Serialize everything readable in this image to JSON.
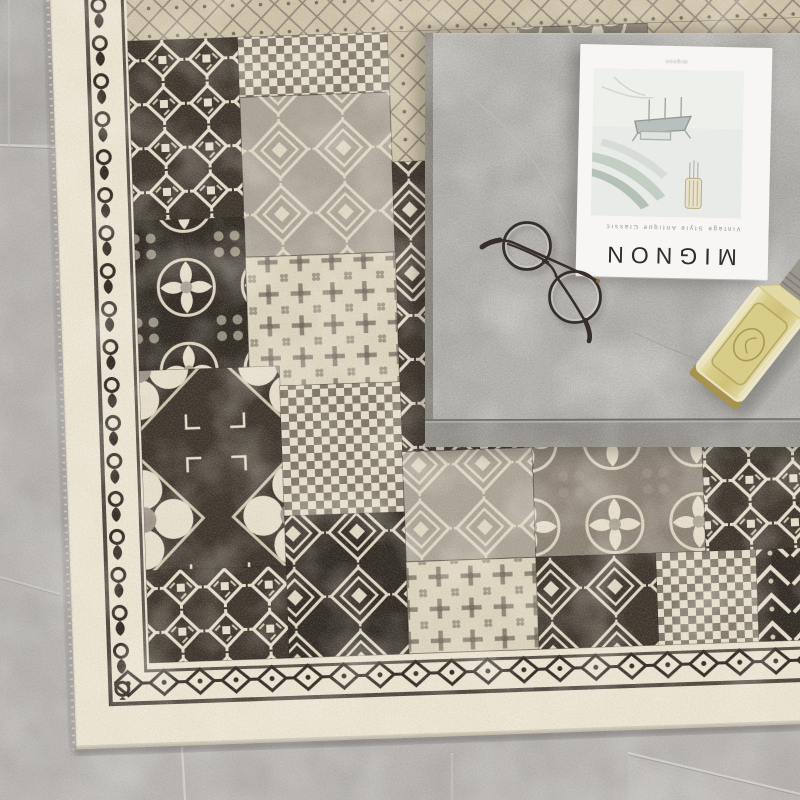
{
  "scene": {
    "floor": {
      "base": "#b8b5b2",
      "grout_light": "#d6d4d0",
      "grout_dark": "#94918c",
      "grout_lines": [
        {
          "x1": 0,
          "y1": 145,
          "x2": 58,
          "y2": 147,
          "strength": 0.8
        },
        {
          "x1": 9,
          "y1": 0,
          "x2": 9,
          "y2": 144,
          "strength": 0.35
        },
        {
          "x1": 0,
          "y1": 577,
          "x2": 60,
          "y2": 594,
          "strength": 0.5
        },
        {
          "x1": 182,
          "y1": 747,
          "x2": 185,
          "y2": 800,
          "strength": 0.9
        },
        {
          "x1": 452,
          "y1": 753,
          "x2": 452,
          "y2": 800,
          "strength": 0.45
        },
        {
          "x1": 628,
          "y1": 753,
          "x2": 800,
          "y2": 794,
          "strength": 0.8
        }
      ]
    },
    "table": {
      "material": "concrete",
      "surface": "#b4b2af",
      "bottom_edge": "#928f8a",
      "left_edge": "#86837d"
    },
    "rug": {
      "style": "vintage-patchwork",
      "selvage": "#ece5d2",
      "field": "#8a8173",
      "dark": "#3a332a",
      "darker": "#2e2821",
      "cream": "#e7dfcc",
      "gray": "#aaa396",
      "tan": "#cfc3a8",
      "borders": {
        "left": "vine-scroll",
        "bottom": "zigzag-diamond",
        "top": "diamond-lattice"
      },
      "patches": [
        {
          "x": 76,
          "y": 46,
          "w": 110,
          "h": 180,
          "base": "#3a332a",
          "pat": "p-hooks"
        },
        {
          "x": 186,
          "y": 46,
          "w": 150,
          "h": 60,
          "base": "#6b6254",
          "pat": "p-checker"
        },
        {
          "x": 336,
          "y": 46,
          "w": 130,
          "h": 130,
          "base": "#cfc3a8",
          "pat": "p-lattice"
        },
        {
          "x": 466,
          "y": 46,
          "w": 130,
          "h": 120,
          "base": "#8a8173",
          "pat": "p-floral"
        },
        {
          "x": 596,
          "y": 46,
          "w": 188,
          "h": 140,
          "base": "#cfc3a8",
          "pat": "p-lattice"
        },
        {
          "x": 186,
          "y": 106,
          "w": 150,
          "h": 160,
          "base": "#aaa396",
          "pat": "p-stepped"
        },
        {
          "x": 336,
          "y": 176,
          "w": 130,
          "h": 140,
          "base": "#3a332a",
          "pat": "p-stepped"
        },
        {
          "x": 76,
          "y": 226,
          "w": 110,
          "h": 150,
          "base": "#2e2821",
          "pat": "p-floral"
        },
        {
          "x": 186,
          "y": 266,
          "w": 150,
          "h": 130,
          "base": "#ddd4bd",
          "pat": "p-cross"
        },
        {
          "x": 336,
          "y": 316,
          "w": 130,
          "h": 150,
          "base": "#3a332a",
          "pat": "p-hooks"
        },
        {
          "x": 466,
          "y": 166,
          "w": 130,
          "h": 150,
          "base": "#8a8173",
          "pat": "p-bigfloral"
        },
        {
          "x": 596,
          "y": 186,
          "w": 188,
          "h": 130,
          "base": "#3a332a",
          "pat": "p-stepped"
        },
        {
          "x": 76,
          "y": 376,
          "w": 140,
          "h": 200,
          "base": "#3a332a",
          "pat": "p-bigfloral"
        },
        {
          "x": 216,
          "y": 396,
          "w": 120,
          "h": 130,
          "base": "#6b6254",
          "pat": "p-checker"
        },
        {
          "x": 466,
          "y": 316,
          "w": 130,
          "h": 150,
          "base": "#cfc3a8",
          "pat": "p-lattice"
        },
        {
          "x": 596,
          "y": 316,
          "w": 188,
          "h": 150,
          "base": "#ddd4bd",
          "pat": "p-cross"
        },
        {
          "x": 336,
          "y": 466,
          "w": 130,
          "h": 110,
          "base": "#aaa396",
          "pat": "p-stepped"
        },
        {
          "x": 466,
          "y": 466,
          "w": 170,
          "h": 110,
          "base": "#8a8173",
          "pat": "p-floral"
        },
        {
          "x": 636,
          "y": 466,
          "w": 148,
          "h": 110,
          "base": "#3a332a",
          "pat": "p-hooks"
        },
        {
          "x": 76,
          "y": 576,
          "w": 140,
          "h": 92,
          "base": "#3a332a",
          "pat": "p-hooks"
        },
        {
          "x": 216,
          "y": 526,
          "w": 120,
          "h": 142,
          "base": "#2e2821",
          "pat": "p-stepped"
        },
        {
          "x": 336,
          "y": 576,
          "w": 130,
          "h": 92,
          "base": "#ddd4bd",
          "pat": "p-cross"
        },
        {
          "x": 466,
          "y": 576,
          "w": 120,
          "h": 92,
          "base": "#3a332a",
          "pat": "p-stepped"
        },
        {
          "x": 586,
          "y": 576,
          "w": 100,
          "h": 92,
          "base": "#6b6254",
          "pat": "p-checker"
        },
        {
          "x": 686,
          "y": 576,
          "w": 98,
          "h": 92,
          "base": "#2e2821",
          "pat": "p-tribal"
        }
      ]
    },
    "magazine": {
      "title": "MIGNON",
      "subtitle": "Vintage Style Antique Classic",
      "caption": "mignon",
      "orientation": "upside-down",
      "paper": "#f7f6f4",
      "cover": {
        "bg": "#e8ebe7",
        "leaf": "#c3cec5",
        "line": "#9aa3a1",
        "vase": "#e9e3cd"
      }
    },
    "glasses": {
      "type": "round-metal",
      "frame_color": "#362f29"
    },
    "bottle": {
      "liquid": "#d6ca86",
      "glass_edge": "#efe9cf",
      "base_glass": "#a8934e",
      "neck": "#9b978e"
    }
  }
}
